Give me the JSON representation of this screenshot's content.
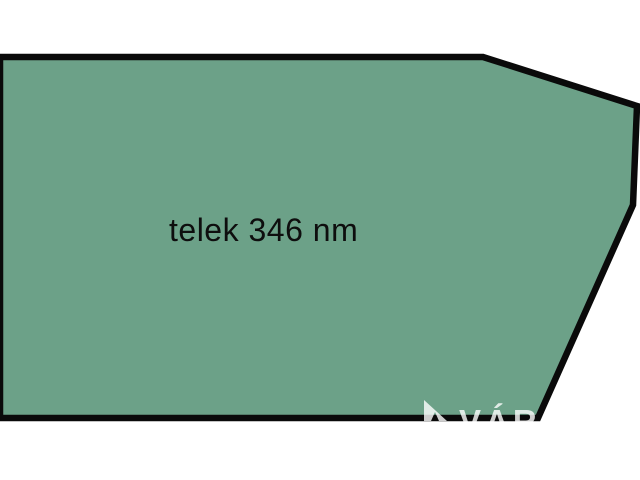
{
  "canvas": {
    "width": 640,
    "height": 480,
    "background": "#ffffff"
  },
  "diagram": {
    "type": "land-plot-sketch",
    "plot": {
      "label": "telek 346 nm",
      "area_value": "346",
      "area_unit": "nm",
      "polygon_points": "0,57 483,57 637,106 633,205 538,418 0,418",
      "fill_color": "#6ca188",
      "border_color": "#0a0a0a",
      "border_width": 6.5
    }
  },
  "watermark": {
    "text": "VÁR",
    "logo_icon": "sail-triangle-icon",
    "logo_points": "424,400 447,421 439,421 435,412 431,421 424,421",
    "color": "#ffffff",
    "opacity": 0.8
  }
}
